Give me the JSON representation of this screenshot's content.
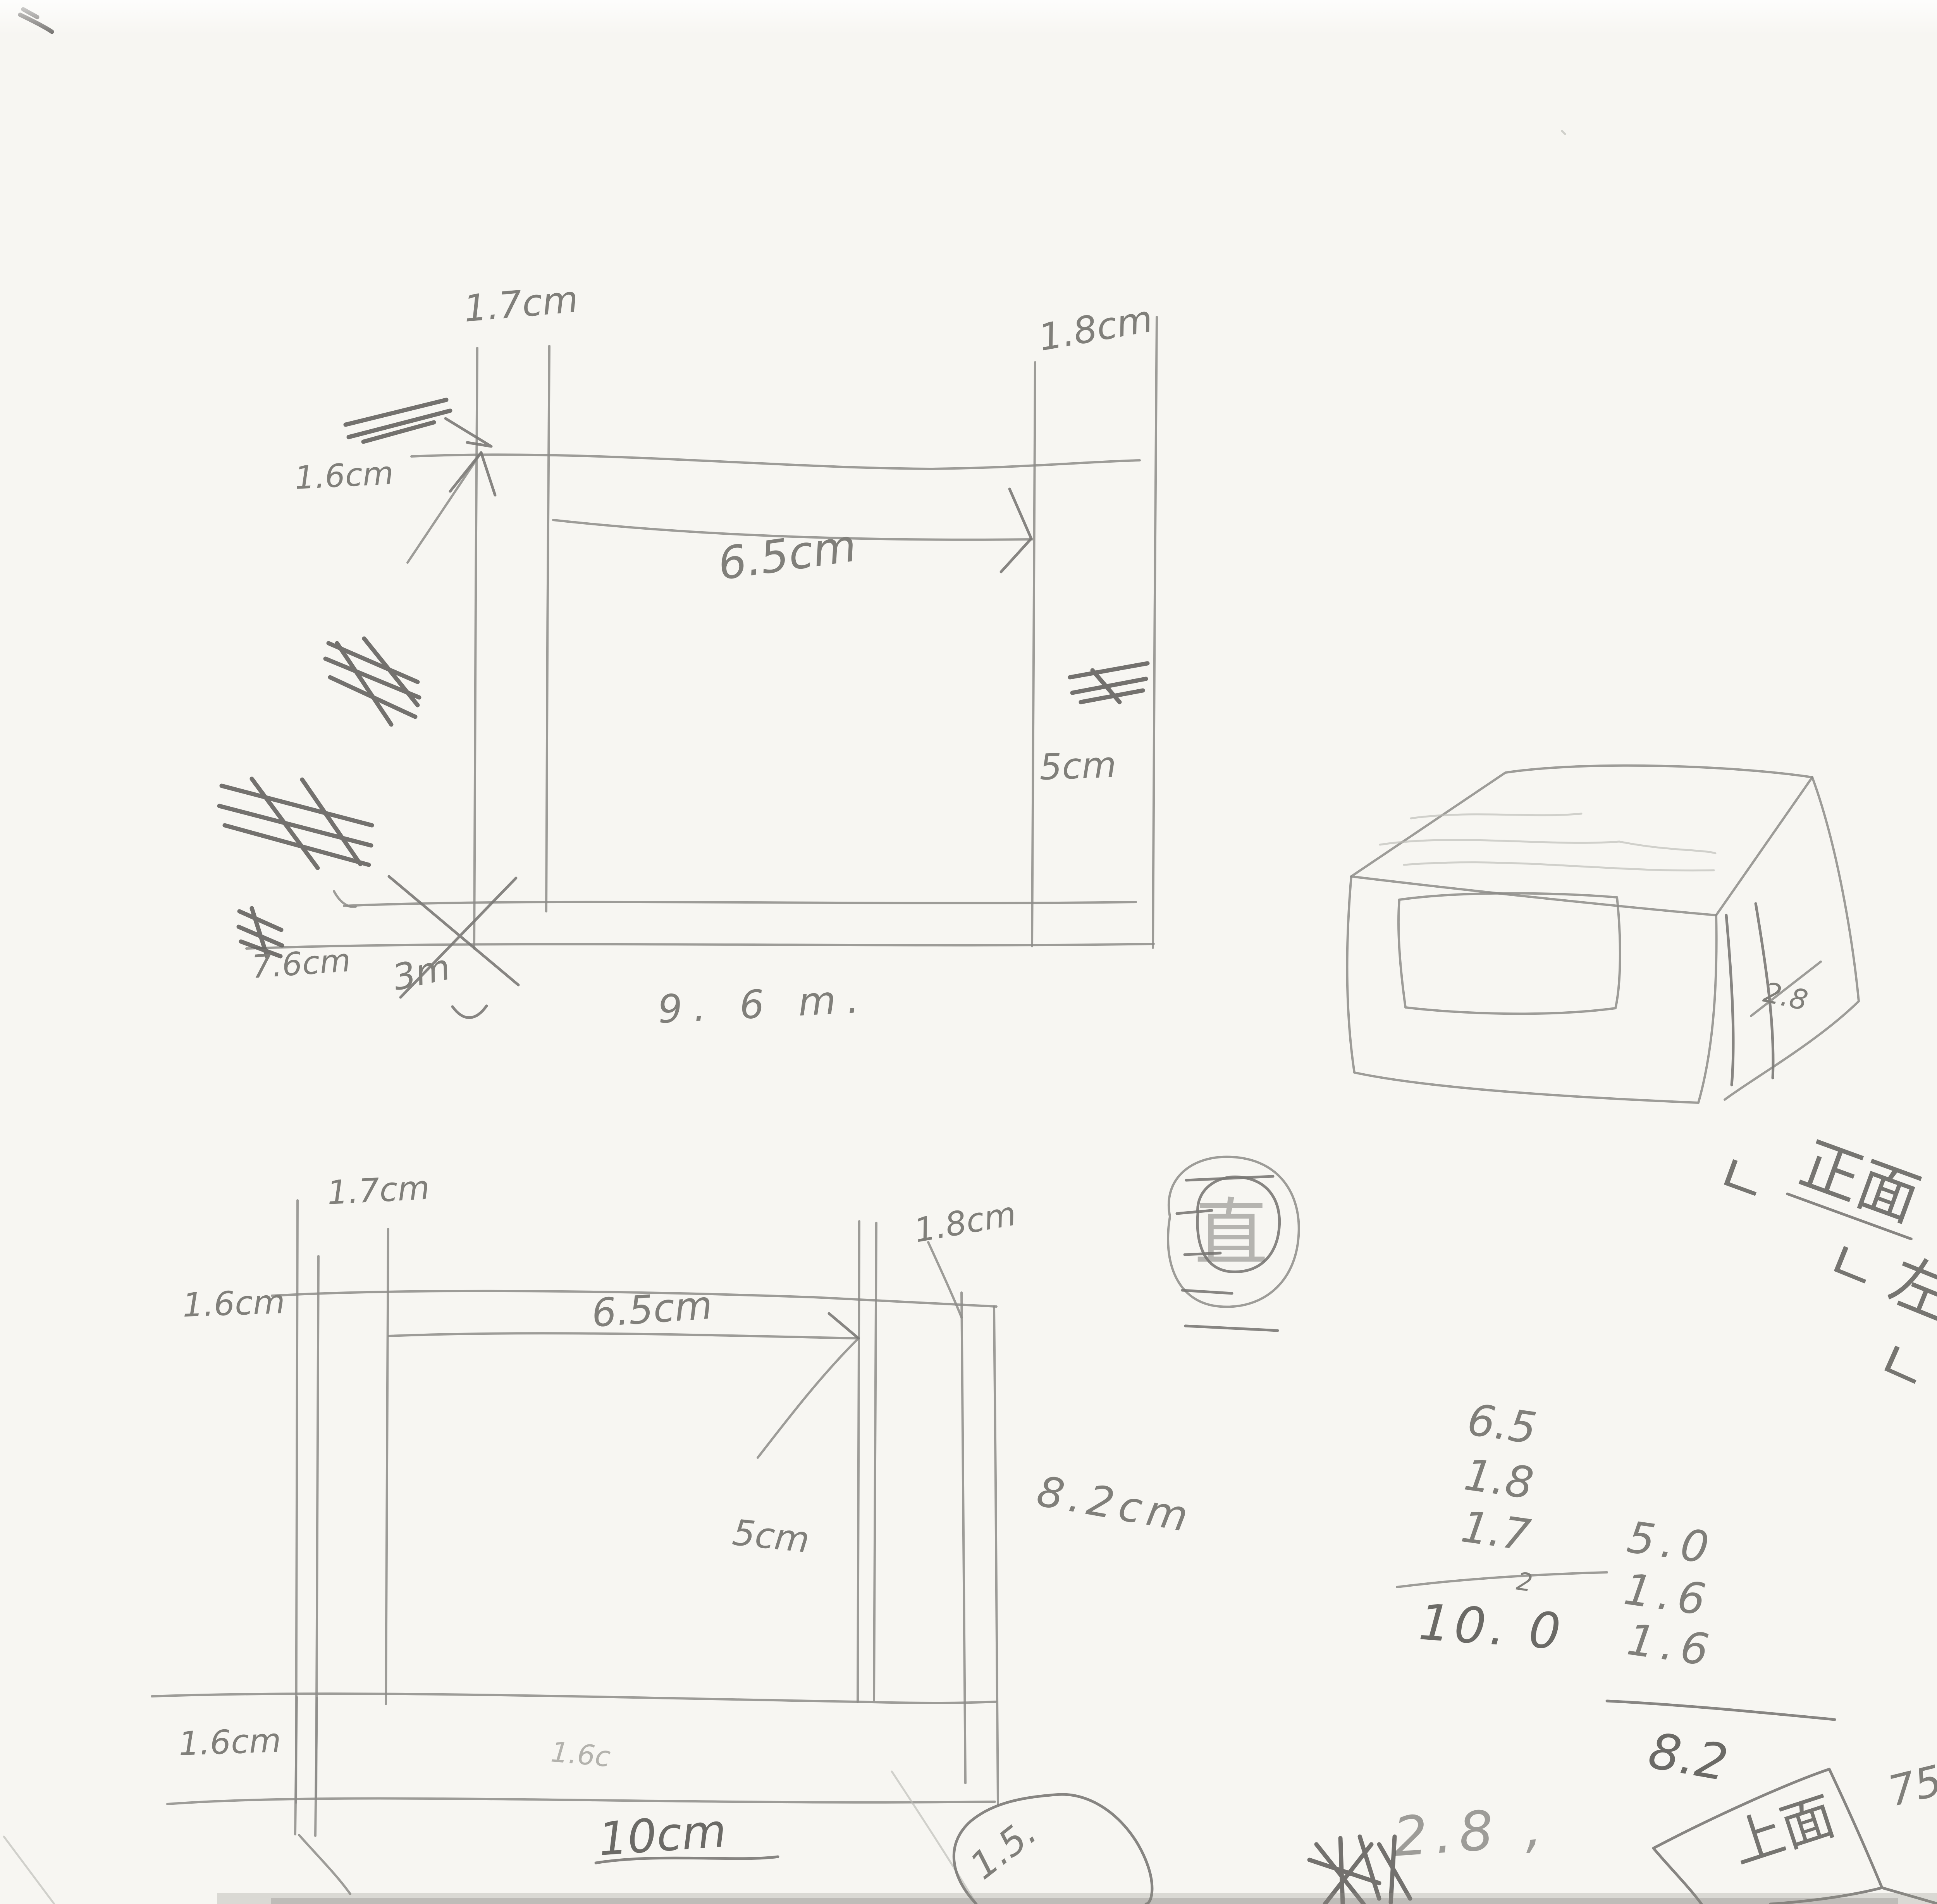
{
  "figure_large_front": {
    "top_left": "1.7cm",
    "top_right": "1.8cm",
    "left": "1.6cm",
    "width": "6.5cm",
    "height": "5cm",
    "bottom_left": "7.6cm",
    "bottom_note": "3m",
    "bottom_width": "9. 6 m."
  },
  "box_3d": {
    "depth": "2.8"
  },
  "circled_character": "直",
  "corner_calc": {
    "a": "82 -",
    "b": "100 -",
    "b_sup": "6",
    "c": "94",
    "d": "94",
    "e": "72"
  },
  "checklist": {
    "items": [
      {
        "prefix": "ㄴ",
        "label": "正面",
        "status": "ok."
      },
      {
        "prefix": "ㄴ",
        "label": "左右",
        "status": "OK"
      },
      {
        "prefix": "ㄴ",
        "label": "背面",
        "status": "OK"
      },
      {
        "prefix": "ㄴ",
        "label": "上面",
        "status": ""
      },
      {
        "prefix": "ㄴ",
        "label": "中板",
        "status": ""
      },
      {
        "prefix": "",
        "label": "底面",
        "status": ""
      },
      {
        "prefix": "",
        "label": "底板",
        "status": ""
      }
    ]
  },
  "figure_small_front": {
    "top_left": "1.7cm",
    "left": "1.6cm",
    "width": "6.5cm",
    "top_right": "1.8cm",
    "height": "5cm",
    "right_height": "8.2cm",
    "bottom_left": "1.6cm",
    "bottom_width": "10cm",
    "faint": "1.6c"
  },
  "addition_left": {
    "rows": [
      "6.5",
      "1.8",
      "1.7"
    ],
    "carry": "2",
    "result": "10. 0"
  },
  "addition_right": {
    "rows": [
      "5.0",
      "1.6",
      "1.6"
    ],
    "result": "8.2"
  },
  "bottom_notes": {
    "depth": "2.8 ,",
    "radius": "1.5.",
    "top_face": "上面",
    "top_face_width": "75mm"
  }
}
